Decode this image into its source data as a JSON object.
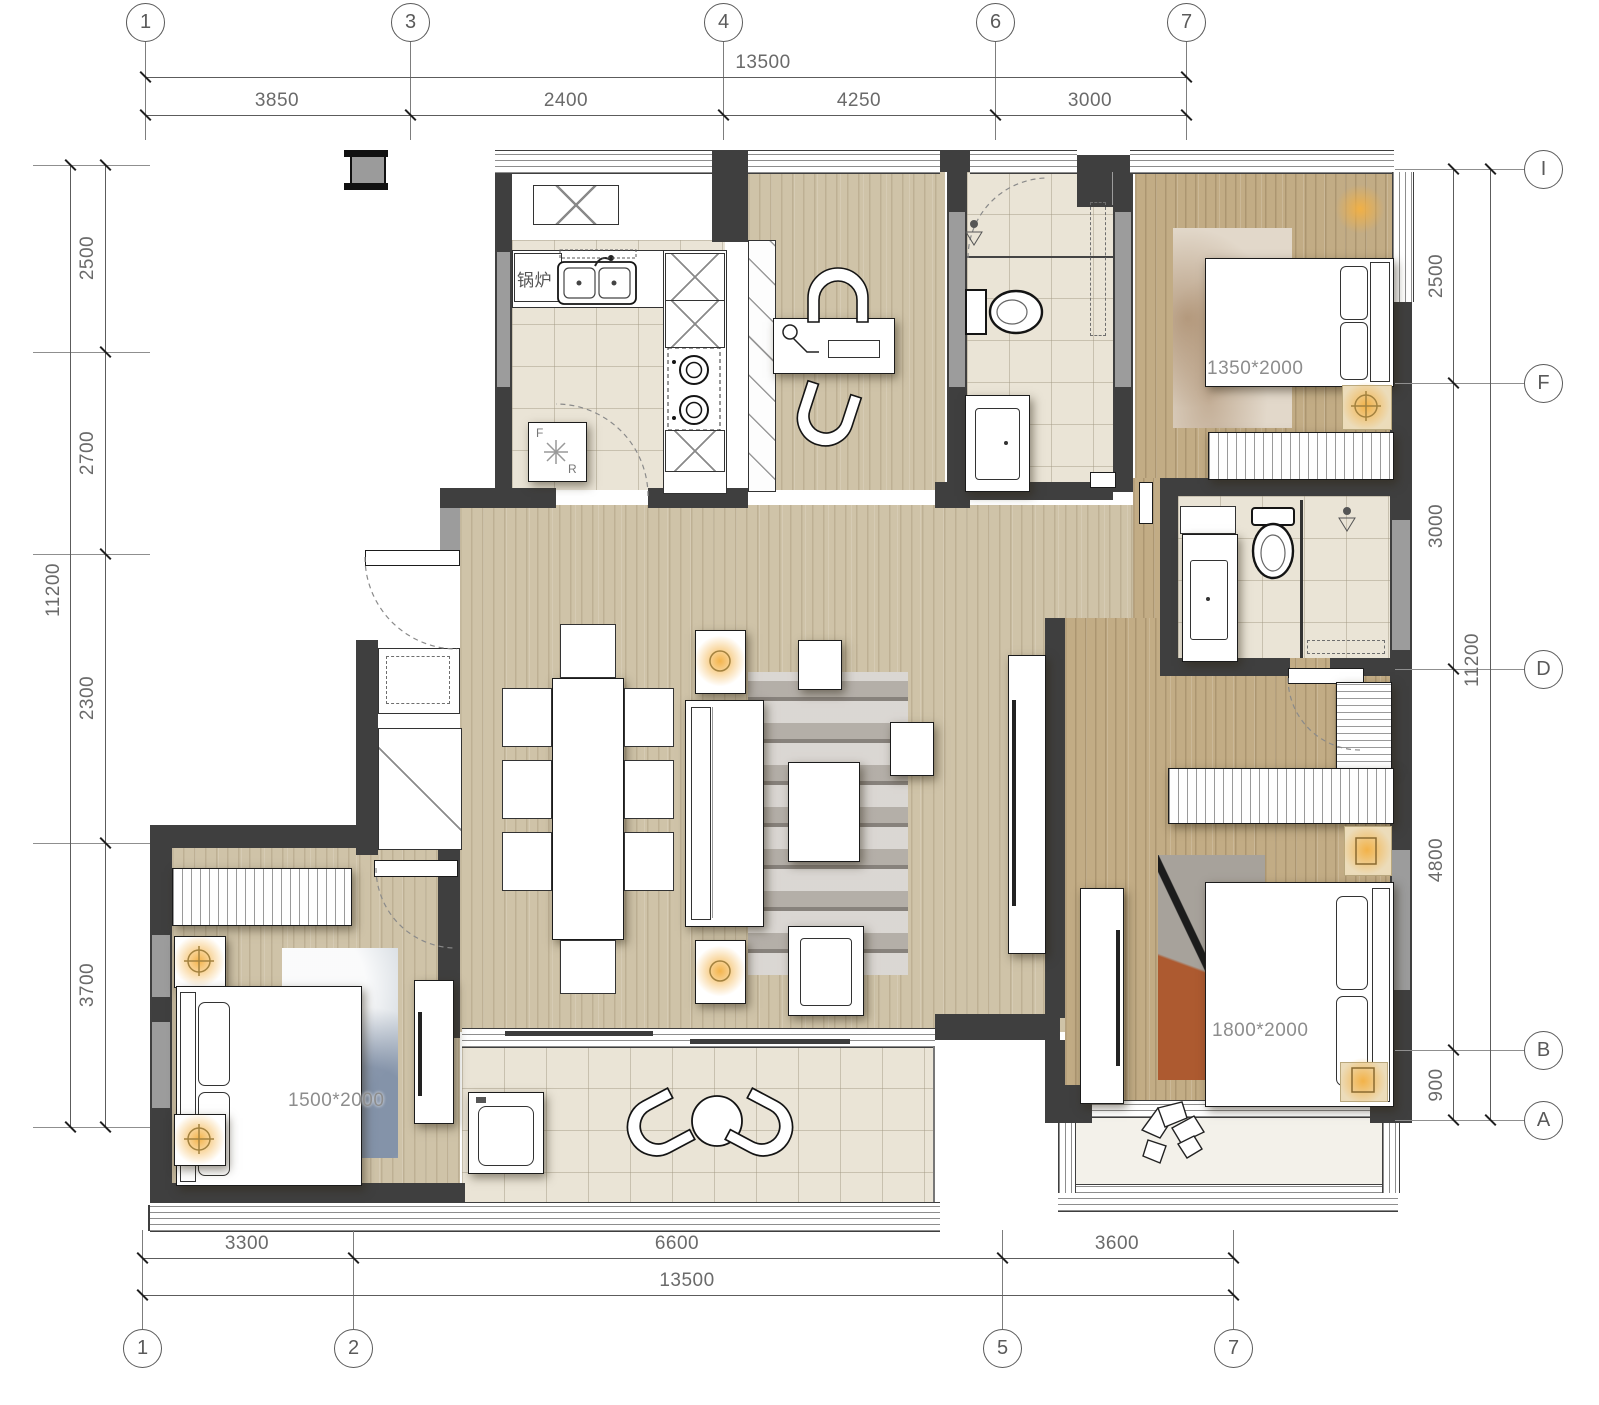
{
  "drawing": {
    "type": "residential-floor-plan",
    "grid": {
      "top": [
        "1",
        "3",
        "4",
        "6",
        "7"
      ],
      "bottom": [
        "1",
        "2",
        "5",
        "7"
      ],
      "right": [
        "I",
        "F",
        "D",
        "B",
        "A"
      ]
    },
    "dims": {
      "top_total": "13500",
      "top_segments": [
        "3850",
        "2400",
        "4250",
        "3000"
      ],
      "bottom_total": "13500",
      "bottom_segments": [
        "3300",
        "6600",
        "3600"
      ],
      "left_total": "11200",
      "left_segments": [
        "2500",
        "2700",
        "2300",
        "3700"
      ],
      "right_total": "11200",
      "right_segments": [
        "2500",
        "3000",
        "4800",
        "900"
      ]
    },
    "labels": {
      "boiler": "锅炉",
      "bed_top_right": "1350*2000",
      "bed_bottom_left": "1500*2000",
      "bed_master": "1800*2000",
      "fridge_top": "F",
      "fridge_bottom": "R"
    },
    "colors": {
      "wall_dark": "#3f3f3f",
      "wall_gray": "#9c9c9c",
      "wood": "#cfc3a8",
      "wood_dark": "#c2ac85",
      "tile": "#eae4d6",
      "accent_glow": "#f3b042",
      "rug_orange": "#ad5a30",
      "line": "#5c5c5c"
    }
  }
}
